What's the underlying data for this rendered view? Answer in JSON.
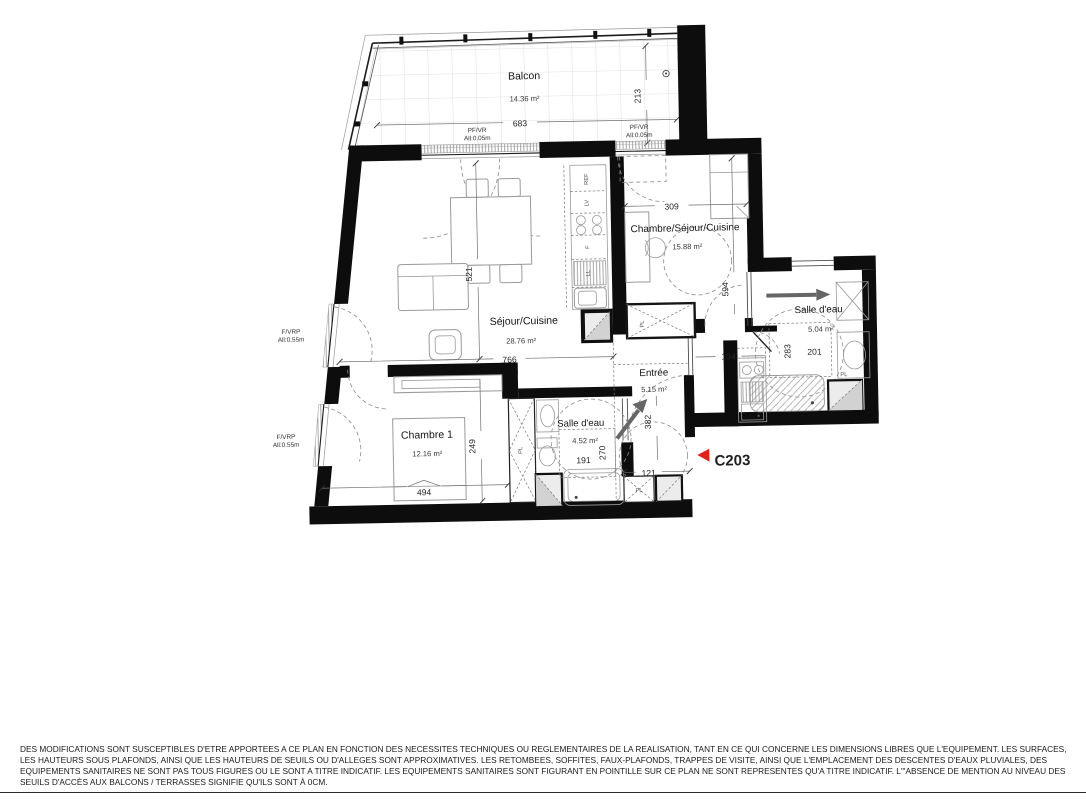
{
  "plan": {
    "unit": {
      "code": "C203"
    },
    "rooms": {
      "balcon": {
        "name": "Balcon",
        "area": "14.36 m²"
      },
      "sejour": {
        "name": "Séjour/Cuisine",
        "area": "28.76 m²"
      },
      "chambre1": {
        "name": "Chambre 1",
        "area": "12.16 m²"
      },
      "sde1": {
        "name": "Salle d'eau",
        "area": "4.52 m²"
      },
      "entree": {
        "name": "Entrée",
        "area": "5.15 m²"
      },
      "studio": {
        "name": "Chambre/Séjour/Cuisine",
        "area": "15.88 m²"
      },
      "sde2": {
        "name": "Salle d'eau",
        "area": "5.04 m²"
      }
    },
    "dims": {
      "balcon_w": "683",
      "balcon_h": "213",
      "sejour_w": "766",
      "sejour_h": "521",
      "chambre1_w": "494",
      "chambre1_h": "249",
      "sde1_w": "191",
      "sde1_h": "270",
      "entree_h": "382",
      "entree_w": "121",
      "studio_w": "309",
      "studio_h": "594",
      "sde2_h": "283",
      "sde2_w": "201",
      "sde2_left": "194"
    },
    "openings": {
      "pfvr": "PF/VR",
      "pfvr_all": "All:0.05m",
      "fvrp": "F/VRP",
      "fvrp_all": "All:0.55m"
    },
    "labels": {
      "closet": "PL",
      "fridge": "REF",
      "dishwasher": "LV",
      "oven": "F",
      "washer": "LL"
    }
  },
  "colors": {
    "wall": "#0d0d0d",
    "accent_red": "#e02318"
  },
  "footer": {
    "disclaimer": "DES MODIFICATIONS SONT SUSCEPTIBLES D'ETRE APPORTEES A CE PLAN EN FONCTION DES NECESSITES TECHNIQUES OU REGLEMENTAIRES DE LA REALISATION, TANT EN CE QUI CONCERNE LES DIMENSIONS LIBRES QUE L'EQUIPEMENT. LES SURFACES, LES HAUTEURS SOUS PLAFONDS, AINSI QUE LES HAUTEURS DE SEUILS OU D'ALLEGES SONT APPROXIMATIVES. LES RETOMBEES, SOFFITES, FAUX-PLAFONDS, TRAPPES DE VISITE, AINSI QUE L'EMPLACEMENT DES DESCENTES D'EAUX PLUVIALES, DES EQUIPEMENTS SANITAIRES NE SONT PAS TOUS FIGURES OU LE SONT A TITRE INDICATIF. LES EQUIPEMENTS SANITAIRES SONT FIGURANT EN POINTILLE SUR CE PLAN NE SONT REPRESENTES QU'A TITRE INDICATIF. L'\"ABSENCE DE MENTION AU NIVEAU DES SEUILS D'ACCÈS AUX BALCONS / TERRASSES SIGNIFIE QU'ILS SONT À 0CM."
  }
}
